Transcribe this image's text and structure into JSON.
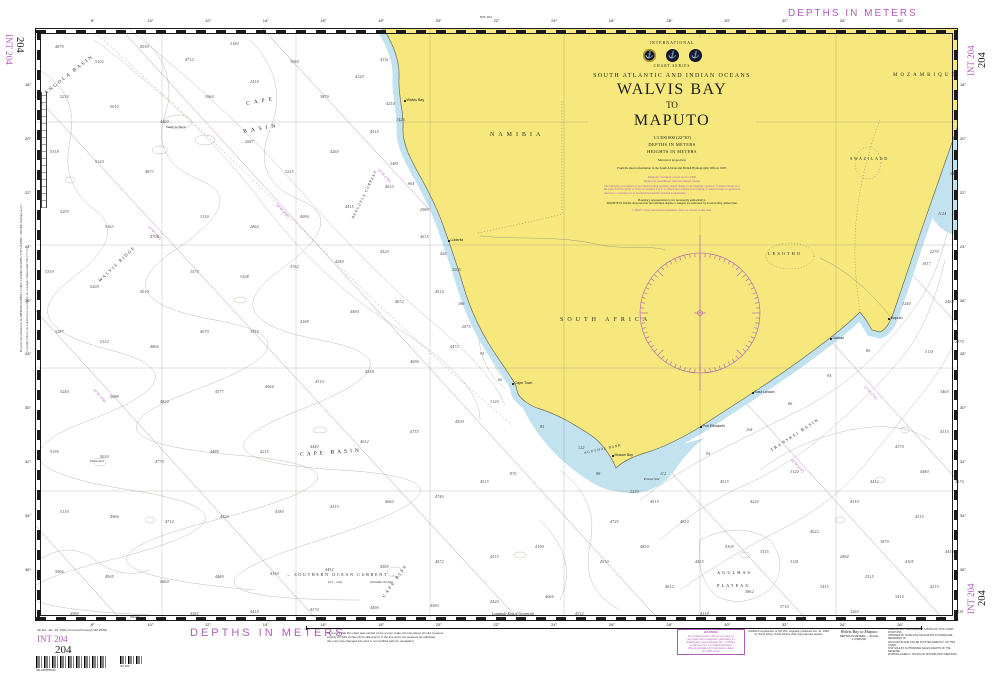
{
  "colors": {
    "magenta": "#b25cba",
    "land": "#f6e87d",
    "shallow": "#c3e2f0",
    "contour": "#b4b4aa"
  },
  "margin": {
    "depths_top": "DEPTHS IN METERS",
    "depths_bottom": "DEPTHS IN METERS",
    "int_no": "INT 204",
    "chart_no": "204",
    "top_center_note": "INT 204",
    "edition_note": "4th Ed., Jan. 25, 1992 (Corrected through NM 25/92)",
    "barcode_caption": "SPL040055904A",
    "barcode2_caption": "INT 204",
    "left_note1": "Prepared and published by the DEFENSE MAPPING AGENCY, HYDROGRAPHIC/TOPOGRAPHIC CENTER, Washington, D.C.",
    "left_note2": "Copyright 1992 by the United States Government. No copyright claimed under Title 17 U.S.C.",
    "scale_note": "To ensure that this chart was printed at the proper scale, the line above should measure\nexactly 24 3/16 inches (614 millimeters). If the line does not measure as indicated,\nthis copy has changed size and is not certified safe for navigation.",
    "warning_title": "WARNING",
    "warning_body": "The prudent mariner will not rely solely on\nany single aid to navigation, particularly on\nfloating aids. See paragraph No. 7 of Notice\nto Mariners No. 1 or Sailing Directions\n(Planning Guides) for information relative\nto a GPS check.",
    "repro_note": "Modified reproduction of INT 204, originally published Oct. 31, 1984,\nby South Africa. South African chart copyright law applies.",
    "title_small": "Walvis Bay to Maputo",
    "title_small_sub": "DEPTHS IN METERS  —  SCALE 1:3,500,000",
    "right_note": "LORAN-C LATTICES ARE NOT SHOWN ON THIS CHART. POSITIONS\nOBTAINED BY SATELLITE NAVIGATION SYSTEMS ARE REFERRED TO\nWGS DATUM AND CAN BE PLOTTED DIRECTLY ON THIS CHART.\nFOR SALE BY AUTHORIZED SALES AGENTS OF THE DEFENSE\nMAPPING AGENCY, OFFICE OF DISTRIBUTION SERVICES.",
    "longitude_note": "Longitude East of Greenwich"
  },
  "title_block": {
    "international": "INTERNATIONAL",
    "chart_series": "CHART SERIES",
    "region": "SOUTH ATLANTIC AND INDIAN OCEANS",
    "title1": "WALVIS BAY",
    "title2": "TO",
    "title3": "MAPUTO",
    "scale": "1:3 500 000 (22°30')",
    "depths": "DEPTHS IN METERS",
    "heights": "HEIGHTS IN METERS",
    "projection": "Mercator projection",
    "source": "From the latest information in the South African and British Hydrographic Offices 1987.",
    "mag1": "Magnetic variation curves are for 1990",
    "mag2": "Figures in parentheses indicate annual change",
    "mag_para": "The following procedure is to be followed when applying annual change to the magnetic variation: if annual change is of the same direction (East or West) as variation it is to be added and variation is increasing; if annual change is opposite in direction to variation it is to be subtracted and the variation is decreasing.",
    "boundary_note": "Boundary representation is not necessarily authoritative.",
    "doubtful": "DOUBTFUL DATA: Reported but unconfirmed depths or dangers are indicated by an encircling dashed line.",
    "cables": "CABLES: Only international submarine cables are shown on this chart."
  },
  "border": {
    "top_labels": [
      "8°",
      "10°",
      "12°",
      "14°",
      "16°",
      "18°",
      "20°",
      "22°",
      "24°",
      "26°",
      "28°",
      "30°",
      "32°",
      "34°",
      "36°"
    ],
    "side_labels": [
      "18°",
      "20°",
      "22°",
      "24°",
      "26°",
      "28°",
      "30°",
      "32°",
      "34°",
      "36°"
    ]
  },
  "grid": {
    "verticals": [
      162,
      296,
      430,
      564,
      700,
      836
    ],
    "horizontals": [
      122,
      245,
      368,
      491
    ]
  },
  "compass": {
    "cx": 700,
    "cy": 313,
    "r": 60
  },
  "geo_labels": [
    {
      "t": "ANGOLA BASIN",
      "x": 44,
      "y": 92,
      "rot": -38,
      "fs": 5,
      "ls": 2
    },
    {
      "t": "CAPE",
      "x": 246,
      "y": 102,
      "rot": -10,
      "fs": 5.5,
      "ls": 4
    },
    {
      "t": "BASIN",
      "x": 243,
      "y": 130,
      "rot": -10,
      "fs": 5.5,
      "ls": 4
    },
    {
      "t": "CAPE BASIN",
      "x": 300,
      "y": 453,
      "rot": -4,
      "fs": 5.5,
      "ls": 3
    },
    {
      "t": "WALVIS RIDGE",
      "x": 98,
      "y": 280,
      "rot": -44,
      "fs": 4.5,
      "ls": 1.5
    },
    {
      "t": "BENGUELA CURRENT",
      "x": 352,
      "y": 218,
      "rot": -64,
      "fs": 3.8,
      "ls": 1,
      "it": 1
    },
    {
      "t": "→ SOUTHERN OCEAN CURRENT →",
      "x": 286,
      "y": 573,
      "fs": 4.2,
      "ls": 1.6
    },
    {
      "t": "(0.5 - 2 kn)",
      "x": 328,
      "y": 581,
      "fs": 3.2,
      "it": 1
    },
    {
      "t": "CAPE  RISE",
      "x": 382,
      "y": 596,
      "rot": -55,
      "fs": 4.4,
      "ls": 2
    },
    {
      "t": "AGULHAS",
      "x": 717,
      "y": 571,
      "fs": 4.4,
      "ls": 2
    },
    {
      "t": "PLATEAU",
      "x": 717,
      "y": 584,
      "fs": 4.4,
      "ls": 2
    },
    {
      "t": "TRANSKEI BASIN",
      "x": 770,
      "y": 449,
      "rot": -33,
      "fs": 4.4,
      "ls": 1.5
    },
    {
      "t": "AGULHAS BANK",
      "x": 584,
      "y": 452,
      "rot": -12,
      "fs": 3.6,
      "ls": 1,
      "it": 1
    },
    {
      "t": "NAMIBIA",
      "x": 490,
      "y": 132,
      "fs": 6,
      "ls": 4
    },
    {
      "t": "SOUTH AFRICA",
      "x": 560,
      "y": 317,
      "fs": 6,
      "ls": 4
    },
    {
      "t": "LESOTHO",
      "x": 768,
      "y": 252,
      "fs": 4.4,
      "ls": 2
    },
    {
      "t": "SWAZILAND",
      "x": 850,
      "y": 157,
      "fs": 4.2,
      "ls": 1.6
    },
    {
      "t": "MOZAMBIQUE",
      "x": 893,
      "y": 73,
      "fs": 5,
      "ls": 3
    },
    {
      "t": "Valdivia Bank",
      "x": 166,
      "y": 126,
      "fs": 3.5,
      "it": 1
    },
    {
      "t": "Vema Smt",
      "x": 90,
      "y": 460,
      "fs": 3.5,
      "it": 1
    },
    {
      "t": "Schmidt-Ott Smt",
      "x": 370,
      "y": 581,
      "fs": 3.5,
      "it": 1
    },
    {
      "t": "Protea Smt",
      "x": 644,
      "y": 478,
      "fs": 3.5,
      "it": 1
    }
  ],
  "cities": [
    {
      "name": "Walvis Bay",
      "x": 404,
      "y": 100
    },
    {
      "name": "Lüderitz",
      "x": 448,
      "y": 240
    },
    {
      "name": "Cape Town",
      "x": 512,
      "y": 383
    },
    {
      "name": "Mossel Bay",
      "x": 612,
      "y": 455
    },
    {
      "name": "Port Elizabeth",
      "x": 700,
      "y": 426
    },
    {
      "name": "East London",
      "x": 752,
      "y": 392
    },
    {
      "name": "Durban",
      "x": 830,
      "y": 338
    },
    {
      "name": "Maputo",
      "x": 888,
      "y": 318
    }
  ],
  "isogonics": [
    {
      "x1": 35,
      "y1": 95,
      "x2": 520,
      "y2": 621,
      "t": "22°W (3'W)",
      "lx": 150,
      "ly": 225,
      "rot": 47
    },
    {
      "x1": 120,
      "y1": 28,
      "x2": 660,
      "y2": 621,
      "t": "24°W (4'W)",
      "lx": 278,
      "ly": 203,
      "rot": 47
    },
    {
      "x1": 262,
      "y1": 28,
      "x2": 808,
      "y2": 621,
      "t": "25°W (5'W)",
      "lx": 380,
      "ly": 168,
      "rot": 47
    },
    {
      "x1": 404,
      "y1": 28,
      "x2": 945,
      "y2": 621,
      "t": "26°W (6'W)",
      "lx": 793,
      "ly": 458,
      "rot": 47
    },
    {
      "x1": 546,
      "y1": 28,
      "x2": 959,
      "y2": 482,
      "t": "27°W (7'W)",
      "lx": 866,
      "ly": 385,
      "rot": 47
    },
    {
      "x1": 688,
      "y1": 28,
      "x2": 959,
      "y2": 326,
      "t": "",
      "lx": 0,
      "ly": 0,
      "rot": 47
    },
    {
      "x1": 35,
      "y1": 310,
      "x2": 318,
      "y2": 621,
      "t": "20°W (3'W)",
      "lx": 95,
      "ly": 388,
      "rot": 47
    },
    {
      "x1": 35,
      "y1": 525,
      "x2": 122,
      "y2": 621,
      "t": "",
      "lx": 0,
      "ly": 0,
      "rot": 47
    }
  ],
  "soundings": [
    [
      55,
      45,
      "4875"
    ],
    [
      95,
      60,
      "5102"
    ],
    [
      140,
      45,
      "4930"
    ],
    [
      185,
      58,
      "4712"
    ],
    [
      230,
      42,
      "3180"
    ],
    [
      60,
      95,
      "5234"
    ],
    [
      110,
      105,
      "5010"
    ],
    [
      160,
      120,
      "4420"
    ],
    [
      205,
      95,
      "3960"
    ],
    [
      250,
      80,
      "2410"
    ],
    [
      290,
      60,
      "3054"
    ],
    [
      320,
      95,
      "3870"
    ],
    [
      355,
      75,
      "4120"
    ],
    [
      50,
      150,
      "5318"
    ],
    [
      95,
      160,
      "5120"
    ],
    [
      145,
      170,
      "4873"
    ],
    [
      245,
      140,
      "2087"
    ],
    [
      285,
      170,
      "3215"
    ],
    [
      330,
      150,
      "4260"
    ],
    [
      370,
      130,
      "4515"
    ],
    [
      60,
      210,
      "5295"
    ],
    [
      105,
      225,
      "5163"
    ],
    [
      150,
      235,
      "4705"
    ],
    [
      200,
      215,
      "3130"
    ],
    [
      250,
      225,
      "2864"
    ],
    [
      300,
      215,
      "4090"
    ],
    [
      345,
      205,
      "4415"
    ],
    [
      385,
      185,
      "4610"
    ],
    [
      390,
      162,
      "3481"
    ],
    [
      386,
      102,
      "4254"
    ],
    [
      380,
      58,
      "4110"
    ],
    [
      45,
      270,
      "5330"
    ],
    [
      90,
      285,
      "5205"
    ],
    [
      140,
      290,
      "4910"
    ],
    [
      190,
      270,
      "3570"
    ],
    [
      240,
      275,
      "3108"
    ],
    [
      290,
      265,
      "3762"
    ],
    [
      335,
      260,
      "4280"
    ],
    [
      380,
      250,
      "4520"
    ],
    [
      420,
      235,
      "4615"
    ],
    [
      420,
      208,
      "2980"
    ],
    [
      55,
      330,
      "5287"
    ],
    [
      100,
      340,
      "5132"
    ],
    [
      150,
      345,
      "4866"
    ],
    [
      200,
      330,
      "4070"
    ],
    [
      250,
      330,
      "3415"
    ],
    [
      300,
      320,
      "4188"
    ],
    [
      350,
      310,
      "4490"
    ],
    [
      395,
      300,
      "4672"
    ],
    [
      435,
      290,
      "4515"
    ],
    [
      462,
      325,
      "2875"
    ],
    [
      60,
      390,
      "5240"
    ],
    [
      110,
      395,
      "5088"
    ],
    [
      160,
      400,
      "4820"
    ],
    [
      215,
      390,
      "4377"
    ],
    [
      265,
      385,
      "4064"
    ],
    [
      315,
      380,
      "4310"
    ],
    [
      365,
      370,
      "4558"
    ],
    [
      410,
      360,
      "4690"
    ],
    [
      450,
      345,
      "4472"
    ],
    [
      50,
      450,
      "5195"
    ],
    [
      100,
      455,
      "5020"
    ],
    [
      155,
      460,
      "4770"
    ],
    [
      210,
      450,
      "4488"
    ],
    [
      260,
      450,
      "4215"
    ],
    [
      310,
      445,
      "4440"
    ],
    [
      360,
      440,
      "4612"
    ],
    [
      410,
      430,
      "4735"
    ],
    [
      455,
      420,
      "4590"
    ],
    [
      490,
      400,
      "3120"
    ],
    [
      60,
      510,
      "5130"
    ],
    [
      110,
      515,
      "4966"
    ],
    [
      165,
      520,
      "4714"
    ],
    [
      220,
      515,
      "4520"
    ],
    [
      275,
      510,
      "4380"
    ],
    [
      330,
      505,
      "4515"
    ],
    [
      385,
      500,
      "4660"
    ],
    [
      435,
      495,
      "4740"
    ],
    [
      480,
      480,
      "4515"
    ],
    [
      510,
      472,
      "870"
    ],
    [
      55,
      570,
      "5066"
    ],
    [
      105,
      575,
      "4905"
    ],
    [
      160,
      580,
      "4660"
    ],
    [
      215,
      575,
      "4480"
    ],
    [
      270,
      572,
      "4350"
    ],
    [
      325,
      568,
      "4452"
    ],
    [
      380,
      565,
      "4585"
    ],
    [
      435,
      560,
      "4672"
    ],
    [
      490,
      555,
      "4515"
    ],
    [
      535,
      545,
      "4190"
    ],
    [
      70,
      612,
      "4988"
    ],
    [
      130,
      615,
      "4820"
    ],
    [
      190,
      612,
      "4585"
    ],
    [
      250,
      610,
      "4415"
    ],
    [
      310,
      608,
      "4370"
    ],
    [
      370,
      606,
      "4490"
    ],
    [
      430,
      604,
      "4580"
    ],
    [
      490,
      600,
      "4420"
    ],
    [
      545,
      595,
      "4066"
    ],
    [
      575,
      612,
      "4312"
    ],
    [
      600,
      560,
      "4510"
    ],
    [
      610,
      520,
      "4725"
    ],
    [
      640,
      545,
      "4830"
    ],
    [
      665,
      585,
      "4612"
    ],
    [
      695,
      560,
      "4415"
    ],
    [
      700,
      612,
      "4318"
    ],
    [
      725,
      545,
      "4105"
    ],
    [
      745,
      590,
      "3862"
    ],
    [
      760,
      550,
      "3515"
    ],
    [
      780,
      605,
      "3710"
    ],
    [
      790,
      560,
      "3118"
    ],
    [
      810,
      530,
      "4022"
    ],
    [
      820,
      585,
      "3415"
    ],
    [
      840,
      555,
      "2864"
    ],
    [
      850,
      610,
      "3260"
    ],
    [
      865,
      575,
      "2515"
    ],
    [
      880,
      540,
      "3870"
    ],
    [
      895,
      595,
      "3415"
    ],
    [
      905,
      560,
      "4105"
    ],
    [
      915,
      515,
      "4310"
    ],
    [
      930,
      585,
      "4215"
    ],
    [
      945,
      550,
      "4410"
    ],
    [
      955,
      610,
      "4118"
    ],
    [
      870,
      480,
      "4412"
    ],
    [
      895,
      445,
      "4370"
    ],
    [
      920,
      470,
      "4480"
    ],
    [
      940,
      430,
      "4315"
    ],
    [
      955,
      480,
      "4170"
    ],
    [
      850,
      500,
      "4310"
    ],
    [
      790,
      470,
      "3120"
    ],
    [
      750,
      500,
      "4230"
    ],
    [
      720,
      480,
      "4515"
    ],
    [
      680,
      520,
      "4810"
    ],
    [
      650,
      500,
      "4915"
    ],
    [
      630,
      490,
      "2210"
    ],
    [
      930,
      250,
      "2270"
    ],
    [
      945,
      300,
      "2464"
    ],
    [
      925,
      350,
      "3115"
    ],
    [
      940,
      390,
      "3465"
    ],
    [
      955,
      340,
      "2870"
    ],
    [
      396,
      118,
      "1426"
    ],
    [
      408,
      182,
      "964"
    ],
    [
      440,
      252,
      "426"
    ],
    [
      458,
      302,
      "186"
    ],
    [
      480,
      352,
      "95"
    ],
    [
      498,
      378,
      "66"
    ],
    [
      540,
      425,
      "85"
    ],
    [
      578,
      446,
      "122"
    ],
    [
      596,
      472,
      "88"
    ],
    [
      660,
      472,
      "112"
    ],
    [
      706,
      452,
      "95"
    ],
    [
      746,
      428,
      "104"
    ],
    [
      788,
      402,
      "86"
    ],
    [
      827,
      374,
      "94"
    ],
    [
      866,
      349,
      "80"
    ],
    [
      902,
      302,
      "1240"
    ],
    [
      922,
      262,
      "1817"
    ],
    [
      938,
      212,
      "1124"
    ],
    [
      950,
      172,
      "586"
    ],
    [
      452,
      268,
      "3205"
    ]
  ]
}
